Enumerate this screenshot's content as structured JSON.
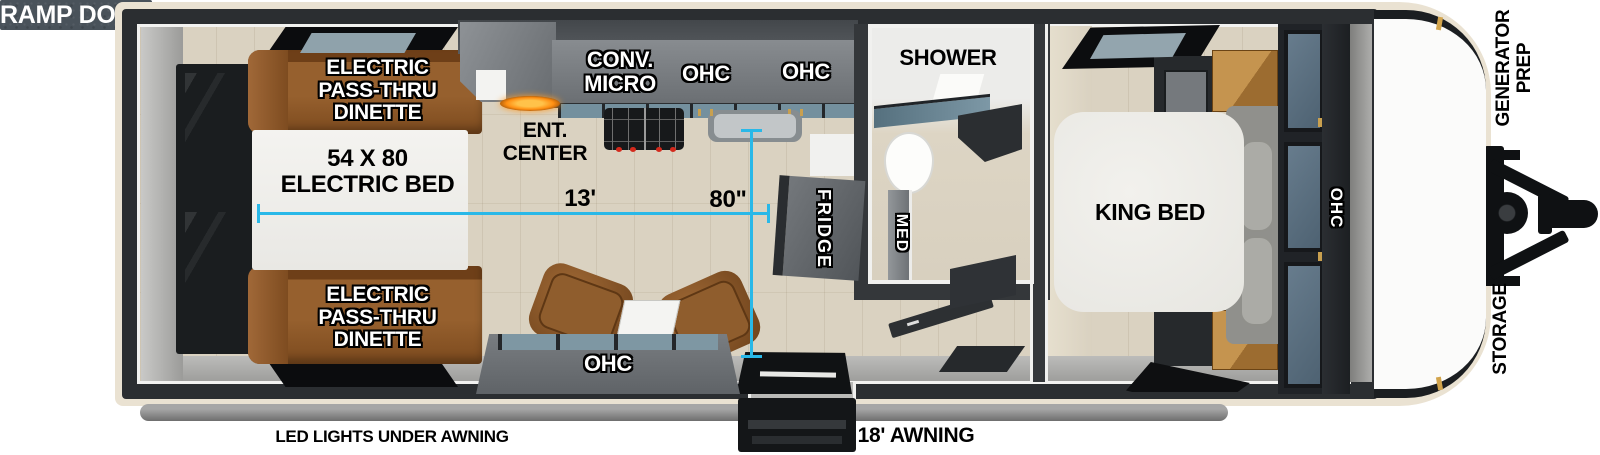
{
  "colors": {
    "dimension_line": "#29B8E8",
    "ramp_door_panel": "#49525A",
    "trailer_wall": "#2B2E31",
    "exterior_trim": "#EAE2D2",
    "floor_wood": "#DAD2C1",
    "cabinet_gray": "#74787C",
    "dinette_brown": "#8A5526",
    "glass_blue": "#74909E",
    "fireplace_flame": "#FF9A1F"
  },
  "exterior": {
    "ramp_door_label": "RAMP DOOR",
    "generator_prep_line1": "GENERATOR",
    "generator_prep_line2": "PREP",
    "storage_label": "STORAGE",
    "led_lights_label": "LED LIGHTS UNDER AWNING",
    "awning_label": "18' AWNING"
  },
  "garage": {
    "dinette_top_line1": "ELECTRIC",
    "dinette_top_line2": "PASS-THRU",
    "dinette_top_line3": "DINETTE",
    "bed_line1": "54 X 80",
    "bed_line2": "ELECTRIC BED",
    "dinette_bottom_line1": "ELECTRIC",
    "dinette_bottom_line2": "PASS-THRU",
    "dinette_bottom_line3": "DINETTE"
  },
  "kitchen": {
    "conv_micro_line1": "CONV.",
    "conv_micro_line2": "MICRO",
    "ohc_left": "OHC",
    "ohc_right": "OHC",
    "ent_center_line1": "ENT.",
    "ent_center_line2": "CENTER",
    "fridge_label": "FRIDGE"
  },
  "living": {
    "ohc_label": "OHC"
  },
  "dimensions": {
    "interior_length": "13'",
    "interior_width": "80\""
  },
  "bathroom": {
    "shower_label": "SHOWER",
    "med_label": "MED"
  },
  "bedroom": {
    "bed_label": "KING BED",
    "ohc_label": "OHC"
  }
}
